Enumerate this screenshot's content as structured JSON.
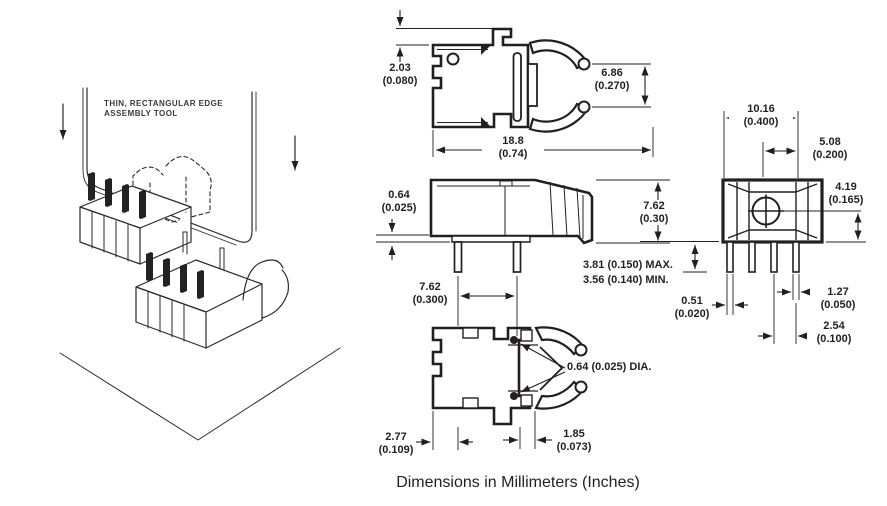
{
  "caption": "Dimensions in Millimeters (Inches)",
  "illustration": {
    "label_line1": "THIN, RECTANGULAR EDGE",
    "label_line2": "ASSEMBLY TOOL"
  },
  "colors": {
    "line": "#231f20",
    "background": "#ffffff"
  },
  "dims": {
    "tab_height": {
      "mm": "2.03",
      "in": "(0.080)"
    },
    "clip_opening": {
      "mm": "6.86",
      "in": "(0.270)"
    },
    "overall_length": {
      "mm": "18.8",
      "in": "(0.74)"
    },
    "base_thickness": {
      "mm": "0.64",
      "in": "(0.025)"
    },
    "body_height": {
      "mm": "7.62",
      "in": "(0.30)"
    },
    "leg_spacing": {
      "mm": "7.62",
      "in": "(0.300)"
    },
    "leg_length_max": "3.81 (0.150) MAX.",
    "leg_length_min": "3.56 (0.140) MIN.",
    "housing_width": {
      "mm": "10.16",
      "in": "(0.400)"
    },
    "center_to_edge": {
      "mm": "5.08",
      "in": "(0.200)"
    },
    "hole_to_base": {
      "mm": "4.19",
      "in": "(0.165)"
    },
    "leg_width": {
      "mm": "0.51",
      "in": "(0.020)"
    },
    "leg_offset": {
      "mm": "1.27",
      "in": "(0.050)"
    },
    "leg_pitch": {
      "mm": "2.54",
      "in": "(0.100)"
    },
    "edge_offset": {
      "mm": "2.77",
      "in": "(0.109)"
    },
    "notch_width": {
      "mm": "1.85",
      "in": "(0.073)"
    },
    "pin_diameter": "0.64 (0.025) DIA."
  }
}
